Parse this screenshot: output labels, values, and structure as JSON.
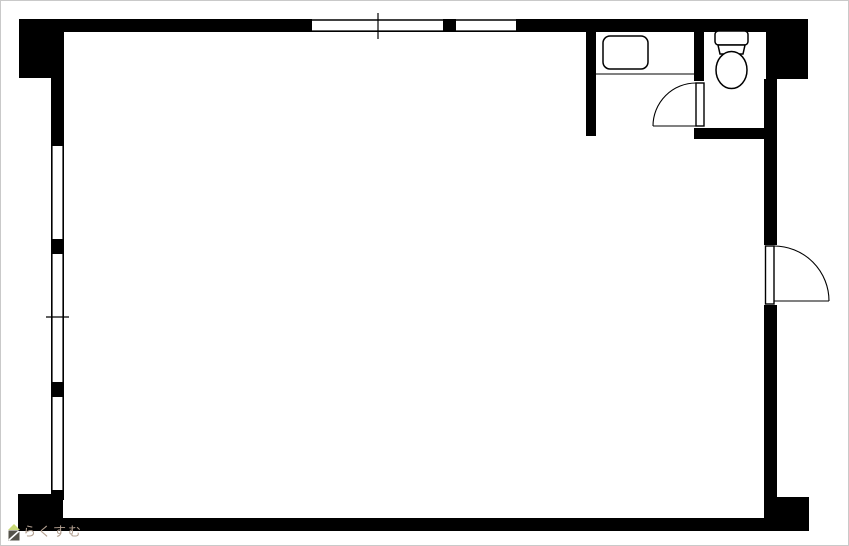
{
  "page": {
    "title": "floor-plan",
    "background": "#ffffff",
    "wall_color": "#000000",
    "line_color": "#000000",
    "border_color": "#c9c9c9"
  },
  "plan": {
    "fixtures": [
      {
        "name": "sink",
        "icon": "sink-icon",
        "location": "washroom-alcove-top-right"
      },
      {
        "name": "toilet",
        "icon": "toilet-icon",
        "location": "toilet-room-top-right"
      }
    ],
    "openings": {
      "top_wall_windows": 2,
      "left_wall_windows": 3,
      "swing_doors": 2
    }
  },
  "watermark": {
    "text": "らくすむ",
    "text_color": "#b3a091",
    "icon_name": "rakusumu-house-logo",
    "icon_roof_color": "#c9d977",
    "icon_base_color": "#54524a",
    "icon_slash_color": "#ffffff"
  }
}
